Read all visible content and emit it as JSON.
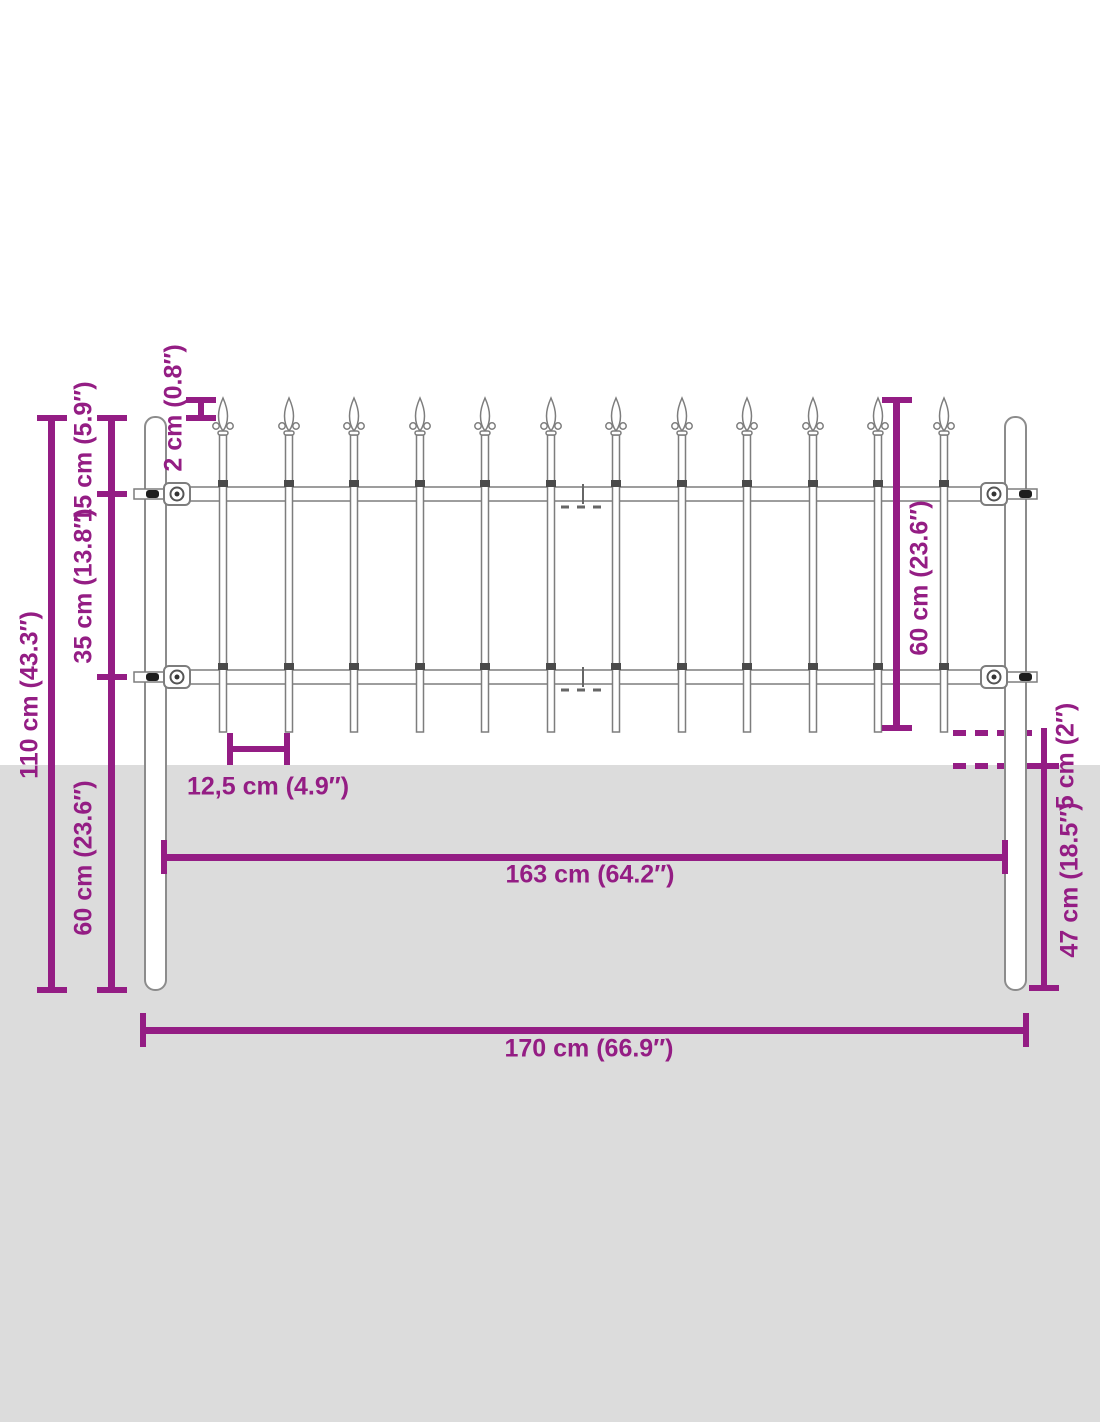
{
  "diagram": {
    "kind": "product dimension diagram",
    "subject": "garden fence panel with spear-top pickets and ground posts",
    "picket_count": 12,
    "colors": {
      "dimension_accent": "#941d84",
      "ground_fill": "#dcdcdc",
      "fence_outline": "#7d7d7d",
      "background": "#ffffff"
    }
  },
  "measurements": {
    "total_height": "110 cm (43.3″)",
    "post_top_to_upper_rail": "15 cm (5.9″)",
    "upper_rail_to_lower_rail": "35 cm (13.8″)",
    "lower_rail_to_post_bottom": "60 cm (23.6″)",
    "spear_above_post_top": "2 cm (0.8″)",
    "picket_length": "60 cm (23.6″)",
    "picket_spacing": "12,5 cm (4.9″)",
    "picket_ground_clearance": "5 cm (2″)",
    "post_depth_below_ground": "47 cm (18.5″)",
    "inner_width_between_posts": "163 cm (64.2″)",
    "total_width": "170 cm (66.9″)"
  }
}
